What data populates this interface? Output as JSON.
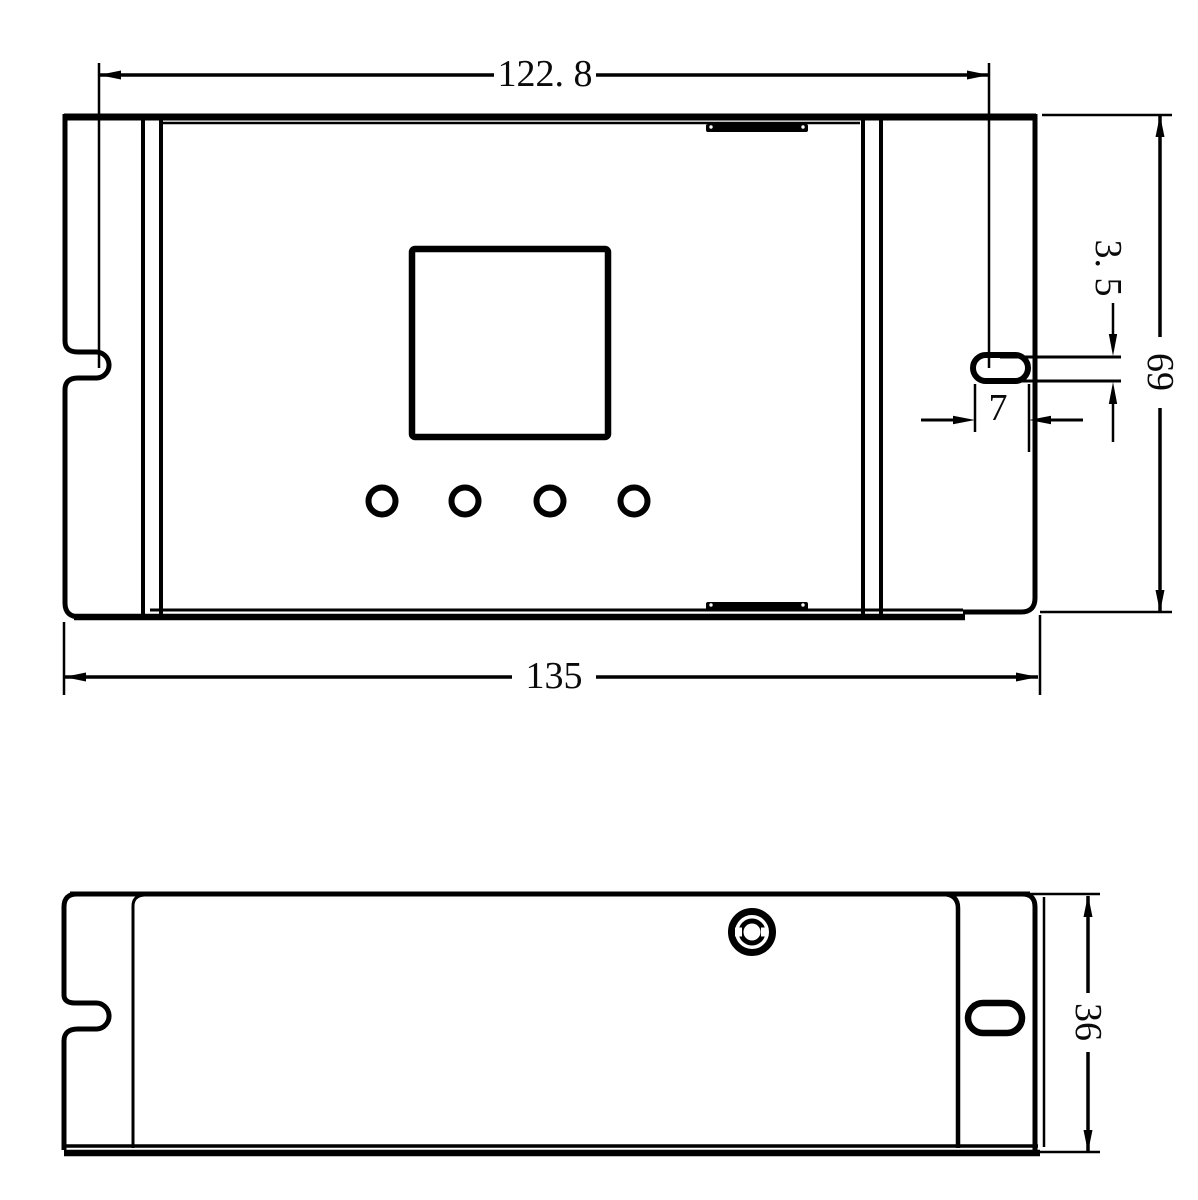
{
  "drawing": {
    "title": "enclosure-dimension-drawing",
    "colors": {
      "background": "#ffffff",
      "stroke": "#000000"
    },
    "dims": {
      "top_width": "122. 8",
      "overall_width": "135",
      "overall_height": "69",
      "slot_height": "3. 5",
      "slot_width": "7",
      "depth": "36"
    },
    "views": {
      "front": {
        "label": "front-view",
        "features": [
          "left-mount-notch",
          "right-mount-slot",
          "display-window",
          "button-row-4-circles",
          "top-latch-tab",
          "bottom-latch-tab"
        ]
      },
      "bottom": {
        "label": "bottom-view",
        "features": [
          "left-mount-notch",
          "screw-head",
          "right-mount-slot"
        ]
      }
    }
  }
}
